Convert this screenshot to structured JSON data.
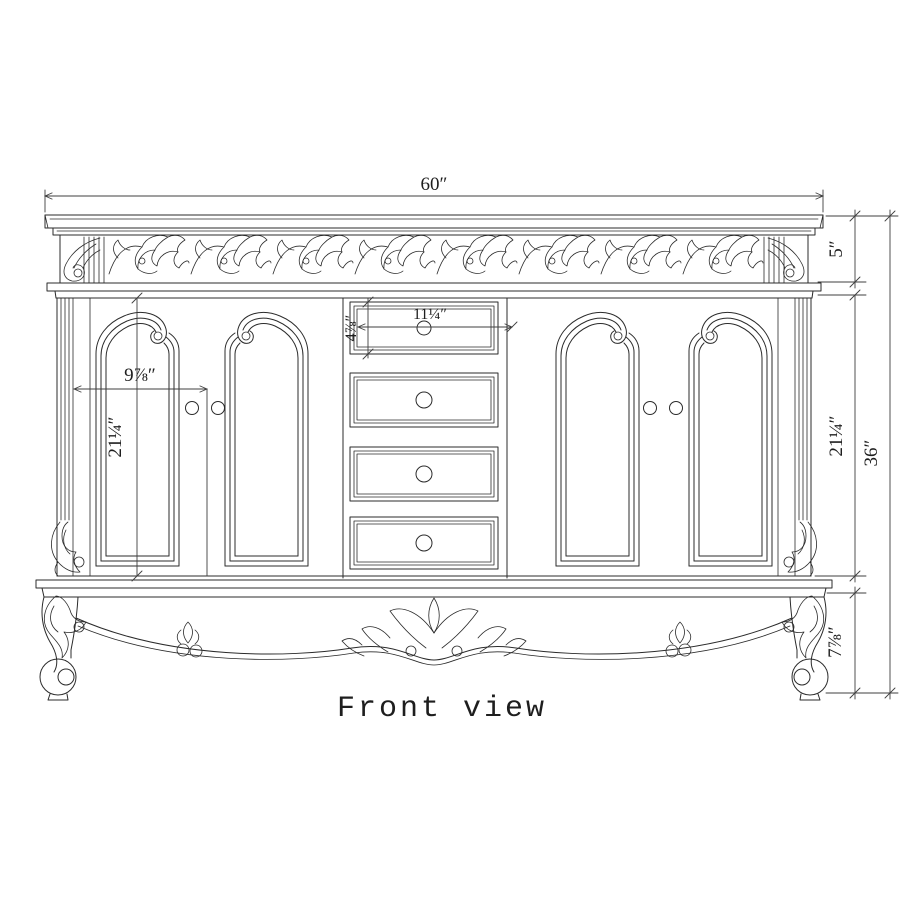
{
  "title": "Front view",
  "dimensions": {
    "top_width": "60″",
    "frieze_height": "5″",
    "body_height_right": "21¼″",
    "total_height": "36″",
    "leg_height": "7⅞″",
    "door_width": "9⅞″",
    "door_height": "21¼″",
    "top_drawer_width": "11¼″",
    "top_drawer_height": "4⅞″"
  },
  "drawing": {
    "type": "orthographic-front-view",
    "subject": "ornate double-door bathroom vanity cabinet with four center drawers, carved frieze, fluted pilasters, scalloped apron and cabriole legs"
  },
  "colors": {
    "drawing_line": "#2b2b2b",
    "dimension_line": "#3f3f3f",
    "background": "#ffffff"
  }
}
